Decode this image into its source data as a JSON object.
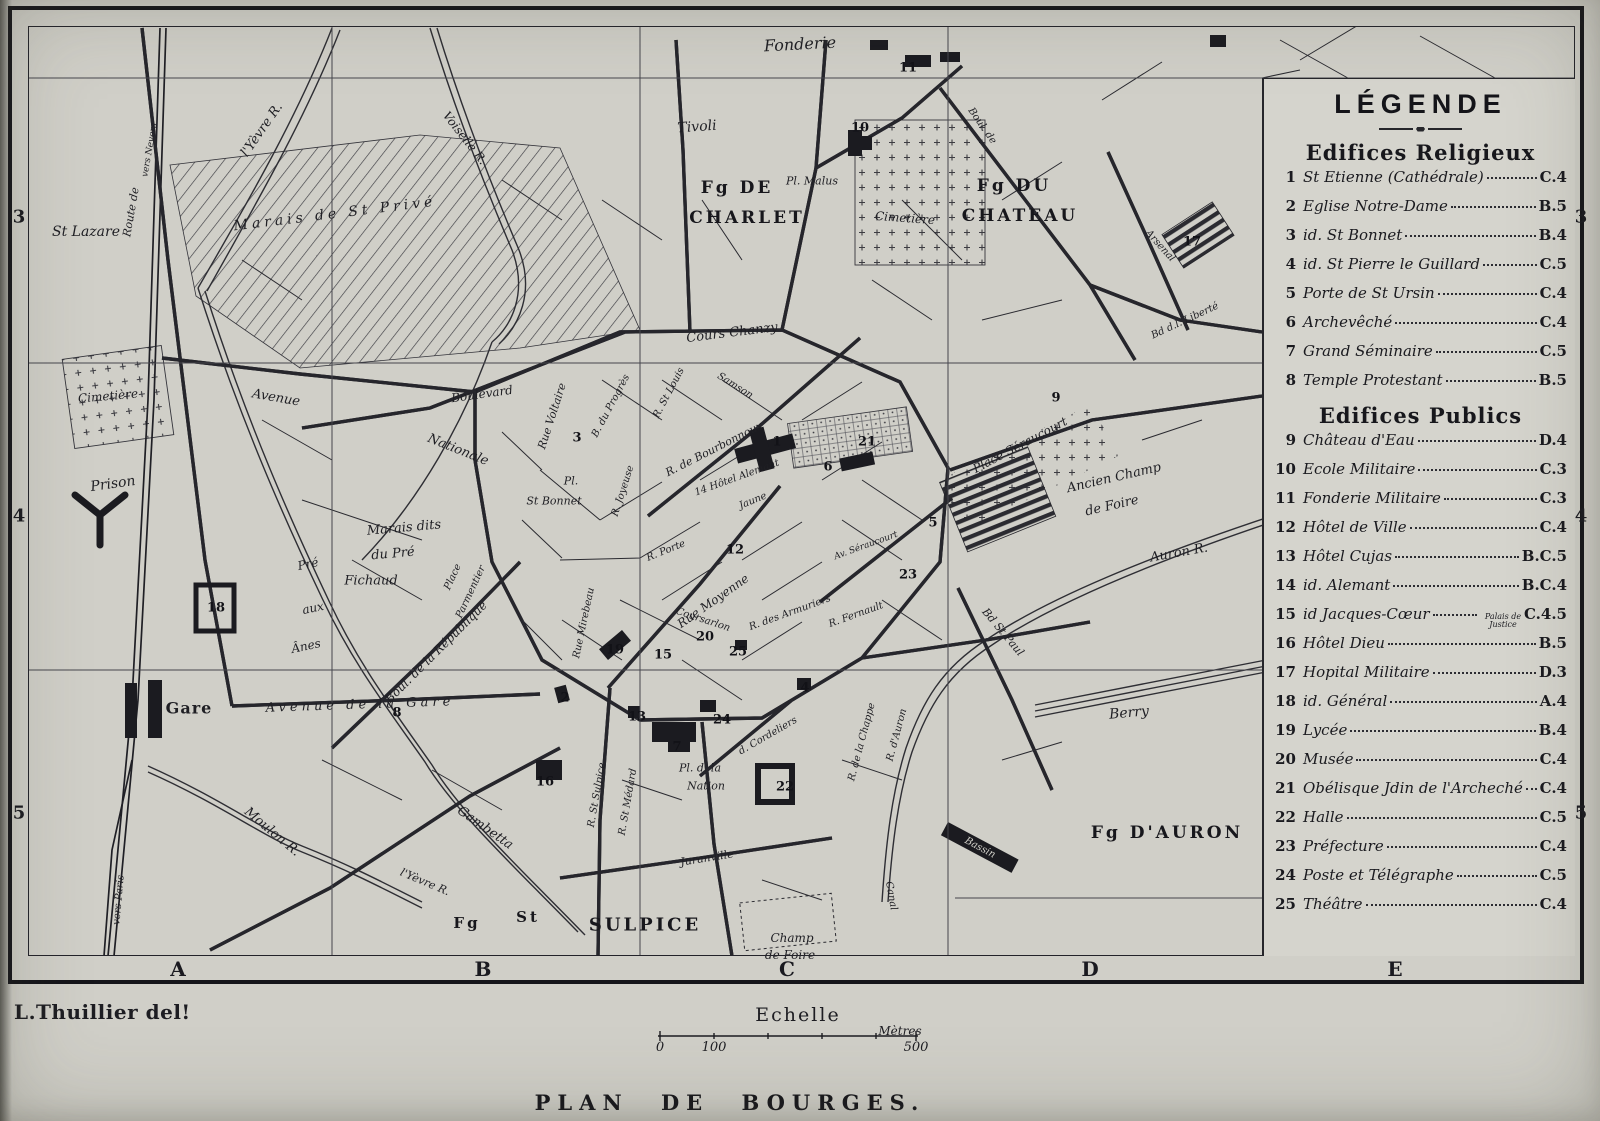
{
  "colors": {
    "paper": "#d0cfc8",
    "paper_light": "#d5d4cd",
    "ink": "#1d1d22"
  },
  "plate": {
    "title": "PLAN DE BOURGES.",
    "credit": "L.Thuillier del!"
  },
  "scale": {
    "heading": "Echelle",
    "unit": "Mètres",
    "unit_x": 900,
    "unit_y": 1024,
    "ticks": [
      {
        "label": "0",
        "x": 660
      },
      {
        "label": "100",
        "x": 714
      },
      {
        "label": "500",
        "x": 916
      }
    ],
    "tick_y": 1040
  },
  "grid": {
    "cols": [
      {
        "label": "A",
        "x": 178
      },
      {
        "label": "B",
        "x": 483
      },
      {
        "label": "C",
        "x": 787
      },
      {
        "label": "D",
        "x": 1090
      },
      {
        "label": "E",
        "x": 1395
      }
    ],
    "rows": [
      {
        "label": "3",
        "y": 217
      },
      {
        "label": "4",
        "y": 516
      },
      {
        "label": "5",
        "y": 813
      }
    ],
    "letters_y": 969,
    "numbers_left_x": 19,
    "numbers_right_x": 1581
  },
  "legend": {
    "title": "LÉGENDE",
    "sections": [
      {
        "heading": "Edifices Religieux",
        "items": [
          {
            "num": "1",
            "label": "St Etienne (Cathédrale)",
            "ref": "C.4"
          },
          {
            "num": "2",
            "label": "Eglise Notre-Dame",
            "ref": "B.5"
          },
          {
            "num": "3",
            "label": "id.  St Bonnet",
            "ref": "B.4"
          },
          {
            "num": "4",
            "label": "id.  St Pierre le Guillard",
            "ref": "C.5"
          },
          {
            "num": "5",
            "label": "Porte de St Ursin",
            "ref": "C.4"
          },
          {
            "num": "6",
            "label": "Archevêché",
            "ref": "C.4"
          },
          {
            "num": "7",
            "label": "Grand Séminaire",
            "ref": "C.5"
          },
          {
            "num": "8",
            "label": "Temple Protestant",
            "ref": "B.5"
          }
        ]
      },
      {
        "heading": "Edifices Publics",
        "items": [
          {
            "num": "9",
            "label": "Château d'Eau",
            "ref": "D.4"
          },
          {
            "num": "10",
            "label": "Ecole Militaire",
            "ref": "C.3"
          },
          {
            "num": "11",
            "label": "Fonderie Militaire",
            "ref": "C.3"
          },
          {
            "num": "12",
            "label": "Hôtel de Ville",
            "ref": "C.4"
          },
          {
            "num": "13",
            "label": "Hôtel Cujas",
            "ref": "B.C.5"
          },
          {
            "num": "14",
            "label": "id. Alemant",
            "ref": "B.C.4"
          },
          {
            "num": "15",
            "label": "id  Jacques-Cœur",
            "note": "Palais de Justice",
            "ref": "C.4.5"
          },
          {
            "num": "16",
            "label": "Hôtel Dieu",
            "ref": "B.5"
          },
          {
            "num": "17",
            "label": "Hopital Militaire",
            "ref": "D.3"
          },
          {
            "num": "18",
            "label": "id.  Général",
            "ref": "A.4"
          },
          {
            "num": "19",
            "label": "Lycée",
            "ref": "B.4"
          },
          {
            "num": "20",
            "label": "Musée",
            "ref": "C.4"
          },
          {
            "num": "21",
            "label": "Obélisque Jdin de l'Archeché",
            "ref": "C.4"
          },
          {
            "num": "22",
            "label": "Halle",
            "ref": "C.5"
          },
          {
            "num": "23",
            "label": "Préfecture",
            "ref": "C.4"
          },
          {
            "num": "24",
            "label": "Poste et Télégraphe",
            "ref": "C.5"
          },
          {
            "num": "25",
            "label": "Théâtre",
            "ref": "C.4"
          }
        ]
      }
    ]
  },
  "map": {
    "labels": [
      {
        "t": "Fonderie",
        "x": 800,
        "y": 44,
        "s": 16,
        "r": -3,
        "c": "it"
      },
      {
        "t": "Tivoli",
        "x": 697,
        "y": 127,
        "s": 14,
        "r": -4,
        "c": "it"
      },
      {
        "t": "Fg DE",
        "x": 737,
        "y": 188,
        "s": 17,
        "r": 0,
        "c": "dist"
      },
      {
        "t": "CHARLET",
        "x": 747,
        "y": 218,
        "s": 17,
        "r": 0,
        "c": "dist"
      },
      {
        "t": "Pl. Malus",
        "x": 812,
        "y": 181,
        "s": 11,
        "r": 0,
        "c": "it"
      },
      {
        "t": "Cimetière",
        "x": 905,
        "y": 218,
        "s": 12,
        "r": 4,
        "c": "it"
      },
      {
        "t": "Fg DU",
        "x": 1014,
        "y": 186,
        "s": 17,
        "r": 0,
        "c": "dist"
      },
      {
        "t": "CHATEAU",
        "x": 1020,
        "y": 216,
        "s": 17,
        "r": 0,
        "c": "dist"
      },
      {
        "t": "St Lazare",
        "x": 86,
        "y": 232,
        "s": 14,
        "r": 0,
        "c": "it"
      },
      {
        "t": "Route de",
        "x": 131,
        "y": 212,
        "s": 11,
        "r": -80,
        "c": "it"
      },
      {
        "t": "vers Nevers",
        "x": 150,
        "y": 150,
        "s": 9,
        "r": -80,
        "c": "it"
      },
      {
        "t": "l'Yèvre R.",
        "x": 262,
        "y": 130,
        "s": 13,
        "r": -55,
        "c": "it"
      },
      {
        "t": "Voiselle R.",
        "x": 465,
        "y": 138,
        "s": 12,
        "r": 52,
        "c": "it"
      },
      {
        "t": "Marais de St Privé",
        "x": 335,
        "y": 214,
        "s": 14,
        "r": -7,
        "c": "sp"
      },
      {
        "t": "Cimetière",
        "x": 108,
        "y": 396,
        "s": 12,
        "r": -5,
        "c": "it"
      },
      {
        "t": "Prison",
        "x": 113,
        "y": 484,
        "s": 14,
        "r": -8,
        "c": "it"
      },
      {
        "t": "Avenue",
        "x": 276,
        "y": 398,
        "s": 13,
        "r": 10,
        "c": "it"
      },
      {
        "t": "Nationale",
        "x": 458,
        "y": 450,
        "s": 13,
        "r": 22,
        "c": "it"
      },
      {
        "t": "Boulevard",
        "x": 482,
        "y": 394,
        "s": 12,
        "r": -8,
        "c": "it"
      },
      {
        "t": "Cours Chanzy",
        "x": 732,
        "y": 333,
        "s": 13,
        "r": -7,
        "c": "it"
      },
      {
        "t": "Rue Voltaire",
        "x": 552,
        "y": 416,
        "s": 11,
        "r": -72,
        "c": "it"
      },
      {
        "t": "Pl.",
        "x": 571,
        "y": 481,
        "s": 11,
        "r": 0,
        "c": "it"
      },
      {
        "t": "St Bonnet",
        "x": 554,
        "y": 501,
        "s": 11,
        "r": 0,
        "c": "it"
      },
      {
        "t": "B. du Progrès",
        "x": 611,
        "y": 406,
        "s": 10,
        "r": -62,
        "c": "it"
      },
      {
        "t": "R. Joyeuse",
        "x": 623,
        "y": 491,
        "s": 10,
        "r": -72,
        "c": "it"
      },
      {
        "t": "R. St Louis",
        "x": 669,
        "y": 393,
        "s": 10,
        "r": -62,
        "c": "it"
      },
      {
        "t": "Samson",
        "x": 735,
        "y": 386,
        "s": 10,
        "r": 32,
        "c": "it"
      },
      {
        "t": "R. de Bourbonnoux",
        "x": 714,
        "y": 449,
        "s": 11,
        "r": -27,
        "c": "it"
      },
      {
        "t": "14 Hôtel Alemant",
        "x": 737,
        "y": 478,
        "s": 10,
        "r": -20,
        "c": "it"
      },
      {
        "t": "R. Porte",
        "x": 666,
        "y": 551,
        "s": 10,
        "r": -22,
        "c": "it"
      },
      {
        "t": "Jaune",
        "x": 753,
        "y": 501,
        "s": 10,
        "r": -22,
        "c": "it"
      },
      {
        "t": "Rue Moyenne",
        "x": 713,
        "y": 601,
        "s": 12,
        "r": -35,
        "c": "it"
      },
      {
        "t": "Coursarlon",
        "x": 703,
        "y": 620,
        "s": 10,
        "r": 18,
        "c": "it"
      },
      {
        "t": "Rue Mirebeau",
        "x": 584,
        "y": 623,
        "s": 10,
        "r": -78,
        "c": "it"
      },
      {
        "t": "R. des Armuriers",
        "x": 790,
        "y": 613,
        "s": 10,
        "r": -20,
        "c": "it"
      },
      {
        "t": "R. Fernault",
        "x": 856,
        "y": 615,
        "s": 10,
        "r": -20,
        "c": "it"
      },
      {
        "t": "R. de la Chappe",
        "x": 862,
        "y": 742,
        "s": 10,
        "r": -75,
        "c": "it"
      },
      {
        "t": "R. d'Auron",
        "x": 897,
        "y": 735,
        "s": 10,
        "r": -75,
        "c": "it"
      },
      {
        "t": "Av. Séraucourt",
        "x": 866,
        "y": 546,
        "s": 9,
        "r": -20,
        "c": "it"
      },
      {
        "t": "Place Séraucourt",
        "x": 1020,
        "y": 445,
        "s": 12,
        "r": -28,
        "c": "it"
      },
      {
        "t": "Ancien Champ",
        "x": 1114,
        "y": 478,
        "s": 13,
        "r": -13,
        "c": "it"
      },
      {
        "t": "de Foire",
        "x": 1112,
        "y": 506,
        "s": 13,
        "r": -13,
        "c": "it"
      },
      {
        "t": "Auron R.",
        "x": 1179,
        "y": 553,
        "s": 13,
        "r": -10,
        "c": "it"
      },
      {
        "t": "Bd St Paul",
        "x": 1003,
        "y": 632,
        "s": 11,
        "r": 50,
        "c": "it"
      },
      {
        "t": "Boul. de",
        "x": 982,
        "y": 126,
        "s": 10,
        "r": 55,
        "c": "it"
      },
      {
        "t": "Arsenal",
        "x": 1160,
        "y": 246,
        "s": 10,
        "r": 48,
        "c": "it"
      },
      {
        "t": "Bd d.l. Liberté",
        "x": 1185,
        "y": 321,
        "s": 10,
        "r": -25,
        "c": "it"
      },
      {
        "t": "Berry",
        "x": 1129,
        "y": 713,
        "s": 14,
        "r": -5,
        "c": "it"
      },
      {
        "t": "Bassin",
        "x": 980,
        "y": 848,
        "s": 10,
        "r": 28,
        "c": "inv"
      },
      {
        "t": "Canal",
        "x": 891,
        "y": 896,
        "s": 10,
        "r": 80,
        "c": "it"
      },
      {
        "t": "Fg D'AURON",
        "x": 1167,
        "y": 833,
        "s": 17,
        "r": 0,
        "c": "dist"
      },
      {
        "t": "Gare",
        "x": 189,
        "y": 708,
        "s": 16,
        "r": 0,
        "c": "b"
      },
      {
        "t": "Avenue  de  la  Gare",
        "x": 360,
        "y": 705,
        "s": 13,
        "r": -2,
        "c": "sp"
      },
      {
        "t": "Boul. de la République",
        "x": 436,
        "y": 652,
        "s": 12,
        "r": -45,
        "c": "it"
      },
      {
        "t": "Place",
        "x": 453,
        "y": 577,
        "s": 10,
        "r": -65,
        "c": "it"
      },
      {
        "t": "Parmentier",
        "x": 471,
        "y": 592,
        "s": 10,
        "r": -65,
        "c": "it"
      },
      {
        "t": "Marais dits",
        "x": 404,
        "y": 528,
        "s": 13,
        "r": -5,
        "c": "it"
      },
      {
        "t": "du Pré",
        "x": 393,
        "y": 554,
        "s": 13,
        "r": -5,
        "c": "it"
      },
      {
        "t": "Fichaud",
        "x": 371,
        "y": 581,
        "s": 13,
        "r": 0,
        "c": "it"
      },
      {
        "t": "Pré",
        "x": 308,
        "y": 564,
        "s": 12,
        "r": -12,
        "c": "it"
      },
      {
        "t": "aux",
        "x": 313,
        "y": 608,
        "s": 12,
        "r": -12,
        "c": "it"
      },
      {
        "t": "Ânes",
        "x": 306,
        "y": 646,
        "s": 12,
        "r": -12,
        "c": "it"
      },
      {
        "t": "Moulon R.",
        "x": 272,
        "y": 832,
        "s": 13,
        "r": 40,
        "c": "it"
      },
      {
        "t": "vers Paris",
        "x": 119,
        "y": 900,
        "s": 10,
        "r": -85,
        "c": "it"
      },
      {
        "t": "Gambetta",
        "x": 485,
        "y": 828,
        "s": 13,
        "r": 35,
        "c": "it"
      },
      {
        "t": "l'Yèvre R.",
        "x": 425,
        "y": 882,
        "s": 11,
        "r": 23,
        "c": "it"
      },
      {
        "t": "Fg",
        "x": 467,
        "y": 923,
        "s": 15,
        "r": 0,
        "c": "dist"
      },
      {
        "t": "St",
        "x": 528,
        "y": 917,
        "s": 15,
        "r": 0,
        "c": "dist"
      },
      {
        "t": "SULPICE",
        "x": 645,
        "y": 925,
        "s": 18,
        "r": 0,
        "c": "dist"
      },
      {
        "t": "Juranville",
        "x": 707,
        "y": 858,
        "s": 11,
        "r": -9,
        "c": "it"
      },
      {
        "t": "d. Cordeliers",
        "x": 768,
        "y": 736,
        "s": 10,
        "r": -30,
        "c": "it"
      },
      {
        "t": "Pl. d. la",
        "x": 700,
        "y": 768,
        "s": 11,
        "r": 0,
        "c": "it"
      },
      {
        "t": "Nation",
        "x": 706,
        "y": 786,
        "s": 11,
        "r": 0,
        "c": "it"
      },
      {
        "t": "R. St Sulpice",
        "x": 597,
        "y": 795,
        "s": 10,
        "r": -80,
        "c": "it"
      },
      {
        "t": "R. St Médard",
        "x": 628,
        "y": 802,
        "s": 10,
        "r": -80,
        "c": "it"
      },
      {
        "t": "Champ",
        "x": 792,
        "y": 938,
        "s": 12,
        "r": 0,
        "c": "it"
      },
      {
        "t": "de Foire",
        "x": 790,
        "y": 955,
        "s": 12,
        "r": 0,
        "c": "it"
      }
    ],
    "markers": [
      {
        "n": "1",
        "x": 777,
        "y": 442
      },
      {
        "n": "2",
        "x": 565,
        "y": 698
      },
      {
        "n": "3",
        "x": 577,
        "y": 438
      },
      {
        "n": "4",
        "x": 805,
        "y": 688
      },
      {
        "n": "5",
        "x": 933,
        "y": 523
      },
      {
        "n": "6",
        "x": 828,
        "y": 467
      },
      {
        "n": "7",
        "x": 677,
        "y": 747
      },
      {
        "n": "8",
        "x": 397,
        "y": 713
      },
      {
        "n": "9",
        "x": 1056,
        "y": 398
      },
      {
        "n": "10",
        "x": 860,
        "y": 128
      },
      {
        "n": "11",
        "x": 908,
        "y": 68
      },
      {
        "n": "12",
        "x": 735,
        "y": 550
      },
      {
        "n": "13",
        "x": 637,
        "y": 717
      },
      {
        "n": "15",
        "x": 663,
        "y": 655
      },
      {
        "n": "16",
        "x": 545,
        "y": 782
      },
      {
        "n": "17",
        "x": 1192,
        "y": 242
      },
      {
        "n": "18",
        "x": 216,
        "y": 608
      },
      {
        "n": "19",
        "x": 615,
        "y": 650
      },
      {
        "n": "20",
        "x": 705,
        "y": 637
      },
      {
        "n": "21",
        "x": 867,
        "y": 442
      },
      {
        "n": "22",
        "x": 785,
        "y": 787
      },
      {
        "n": "23",
        "x": 908,
        "y": 575
      },
      {
        "n": "24",
        "x": 722,
        "y": 720
      },
      {
        "n": "25",
        "x": 738,
        "y": 652
      }
    ]
  }
}
